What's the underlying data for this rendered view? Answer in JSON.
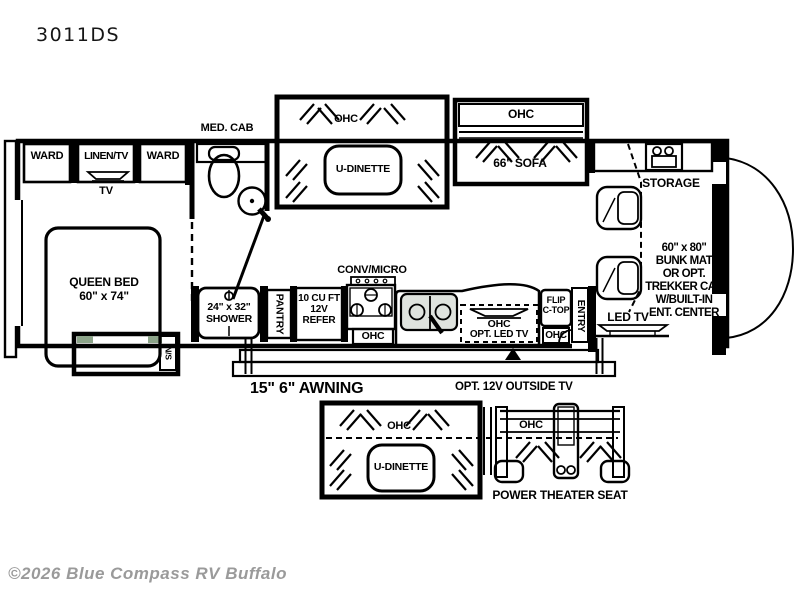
{
  "title": "3011DS",
  "watermark": "©2026 Blue Compass RV Buffalo",
  "colors": {
    "floor": "#8CA489",
    "line": "#000000",
    "watermark": "#9a9a9a",
    "sink": "#dfe3de"
  },
  "labels": {
    "ohc": "OHC"
  },
  "bedroom": {
    "ward_left": "WARD",
    "linen_tv": "LINEN/TV",
    "ward_right": "WARD",
    "tv": "TV",
    "bed_line1": "QUEEN BED",
    "bed_line2": "60\" x 74\"",
    "nightstand": "N/S"
  },
  "bathroom": {
    "med_cab": "MED. CAB",
    "shower_line1": "24\" x 32\"",
    "shower_line2": "SHOWER"
  },
  "kitchen": {
    "pantry": "PANTRY",
    "refer_lines": [
      "10 CU FT",
      "12V",
      "REFER"
    ],
    "conv_micro": "CONV/MICRO",
    "opt_led_tv": "OPT. LED TV",
    "flip_line1": "FLIP",
    "flip_line2": "C-TOP",
    "entry": "ENTRY"
  },
  "living": {
    "u_dinette": "U-DINETTE",
    "sofa": "66\" SOFA"
  },
  "front": {
    "storage": "STORAGE",
    "bunk_lines": [
      "60\" x 80\"",
      "BUNK MAT",
      "OR OPT.",
      "TREKKER CAP",
      "W/BUILT-IN",
      "ENT. CENTER"
    ],
    "led_tv": "LED TV"
  },
  "exterior": {
    "awning": "15\" 6\" AWNING",
    "outside_tv": "OPT. 12V OUTSIDE TV"
  },
  "options": {
    "u_dinette": "U-DINETTE",
    "theater_seat": "POWER THEATER SEAT"
  }
}
